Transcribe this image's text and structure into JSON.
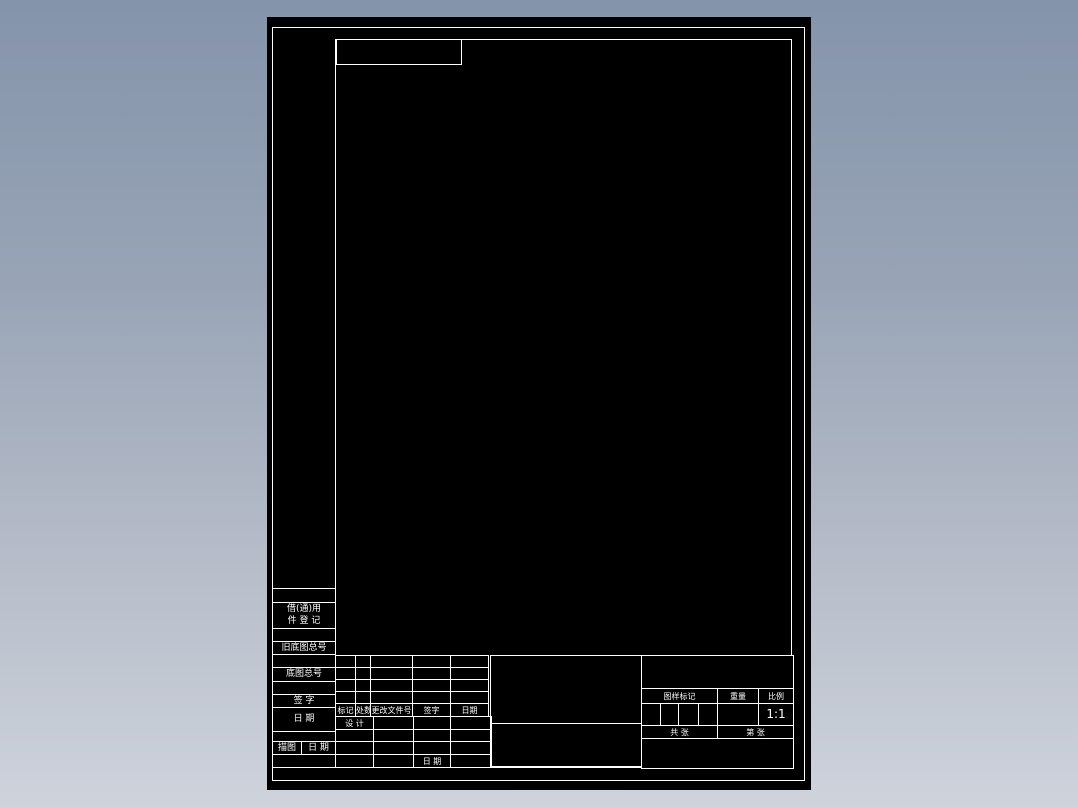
{
  "scene": {
    "description": "Blank Chinese GB standard engineering drawing template sheet viewed in CAD",
    "background_top_color": "#8494ab",
    "background_bottom_color": "#ced3dc",
    "sheet_color": "#000000",
    "line_color": "#ffffff"
  },
  "margin_column": {
    "usage_box_line1": "借(通)用",
    "usage_box_line2": "件 登 记",
    "old_base_drawing_no_label": "旧底图总号",
    "base_drawing_no_label": "底图总号",
    "signature_label": "签  字",
    "date_label": "日  期",
    "trace_label": "描图",
    "trace_date_label": "日 期"
  },
  "revision_table": {
    "col_mark": "标记",
    "col_count": "处数",
    "col_change_file_no": "更改文件号",
    "col_signature": "签字",
    "col_date": "日期"
  },
  "signature_area": {
    "design_label": "设 计",
    "date_label": "日 期"
  },
  "title_block": {
    "drawing_mark_label": "图样标记",
    "weight_label": "重量",
    "scale_label": "比例",
    "scale_value": "1:1",
    "sheets_total_label": "共  张",
    "sheet_no_label": "第  张"
  }
}
